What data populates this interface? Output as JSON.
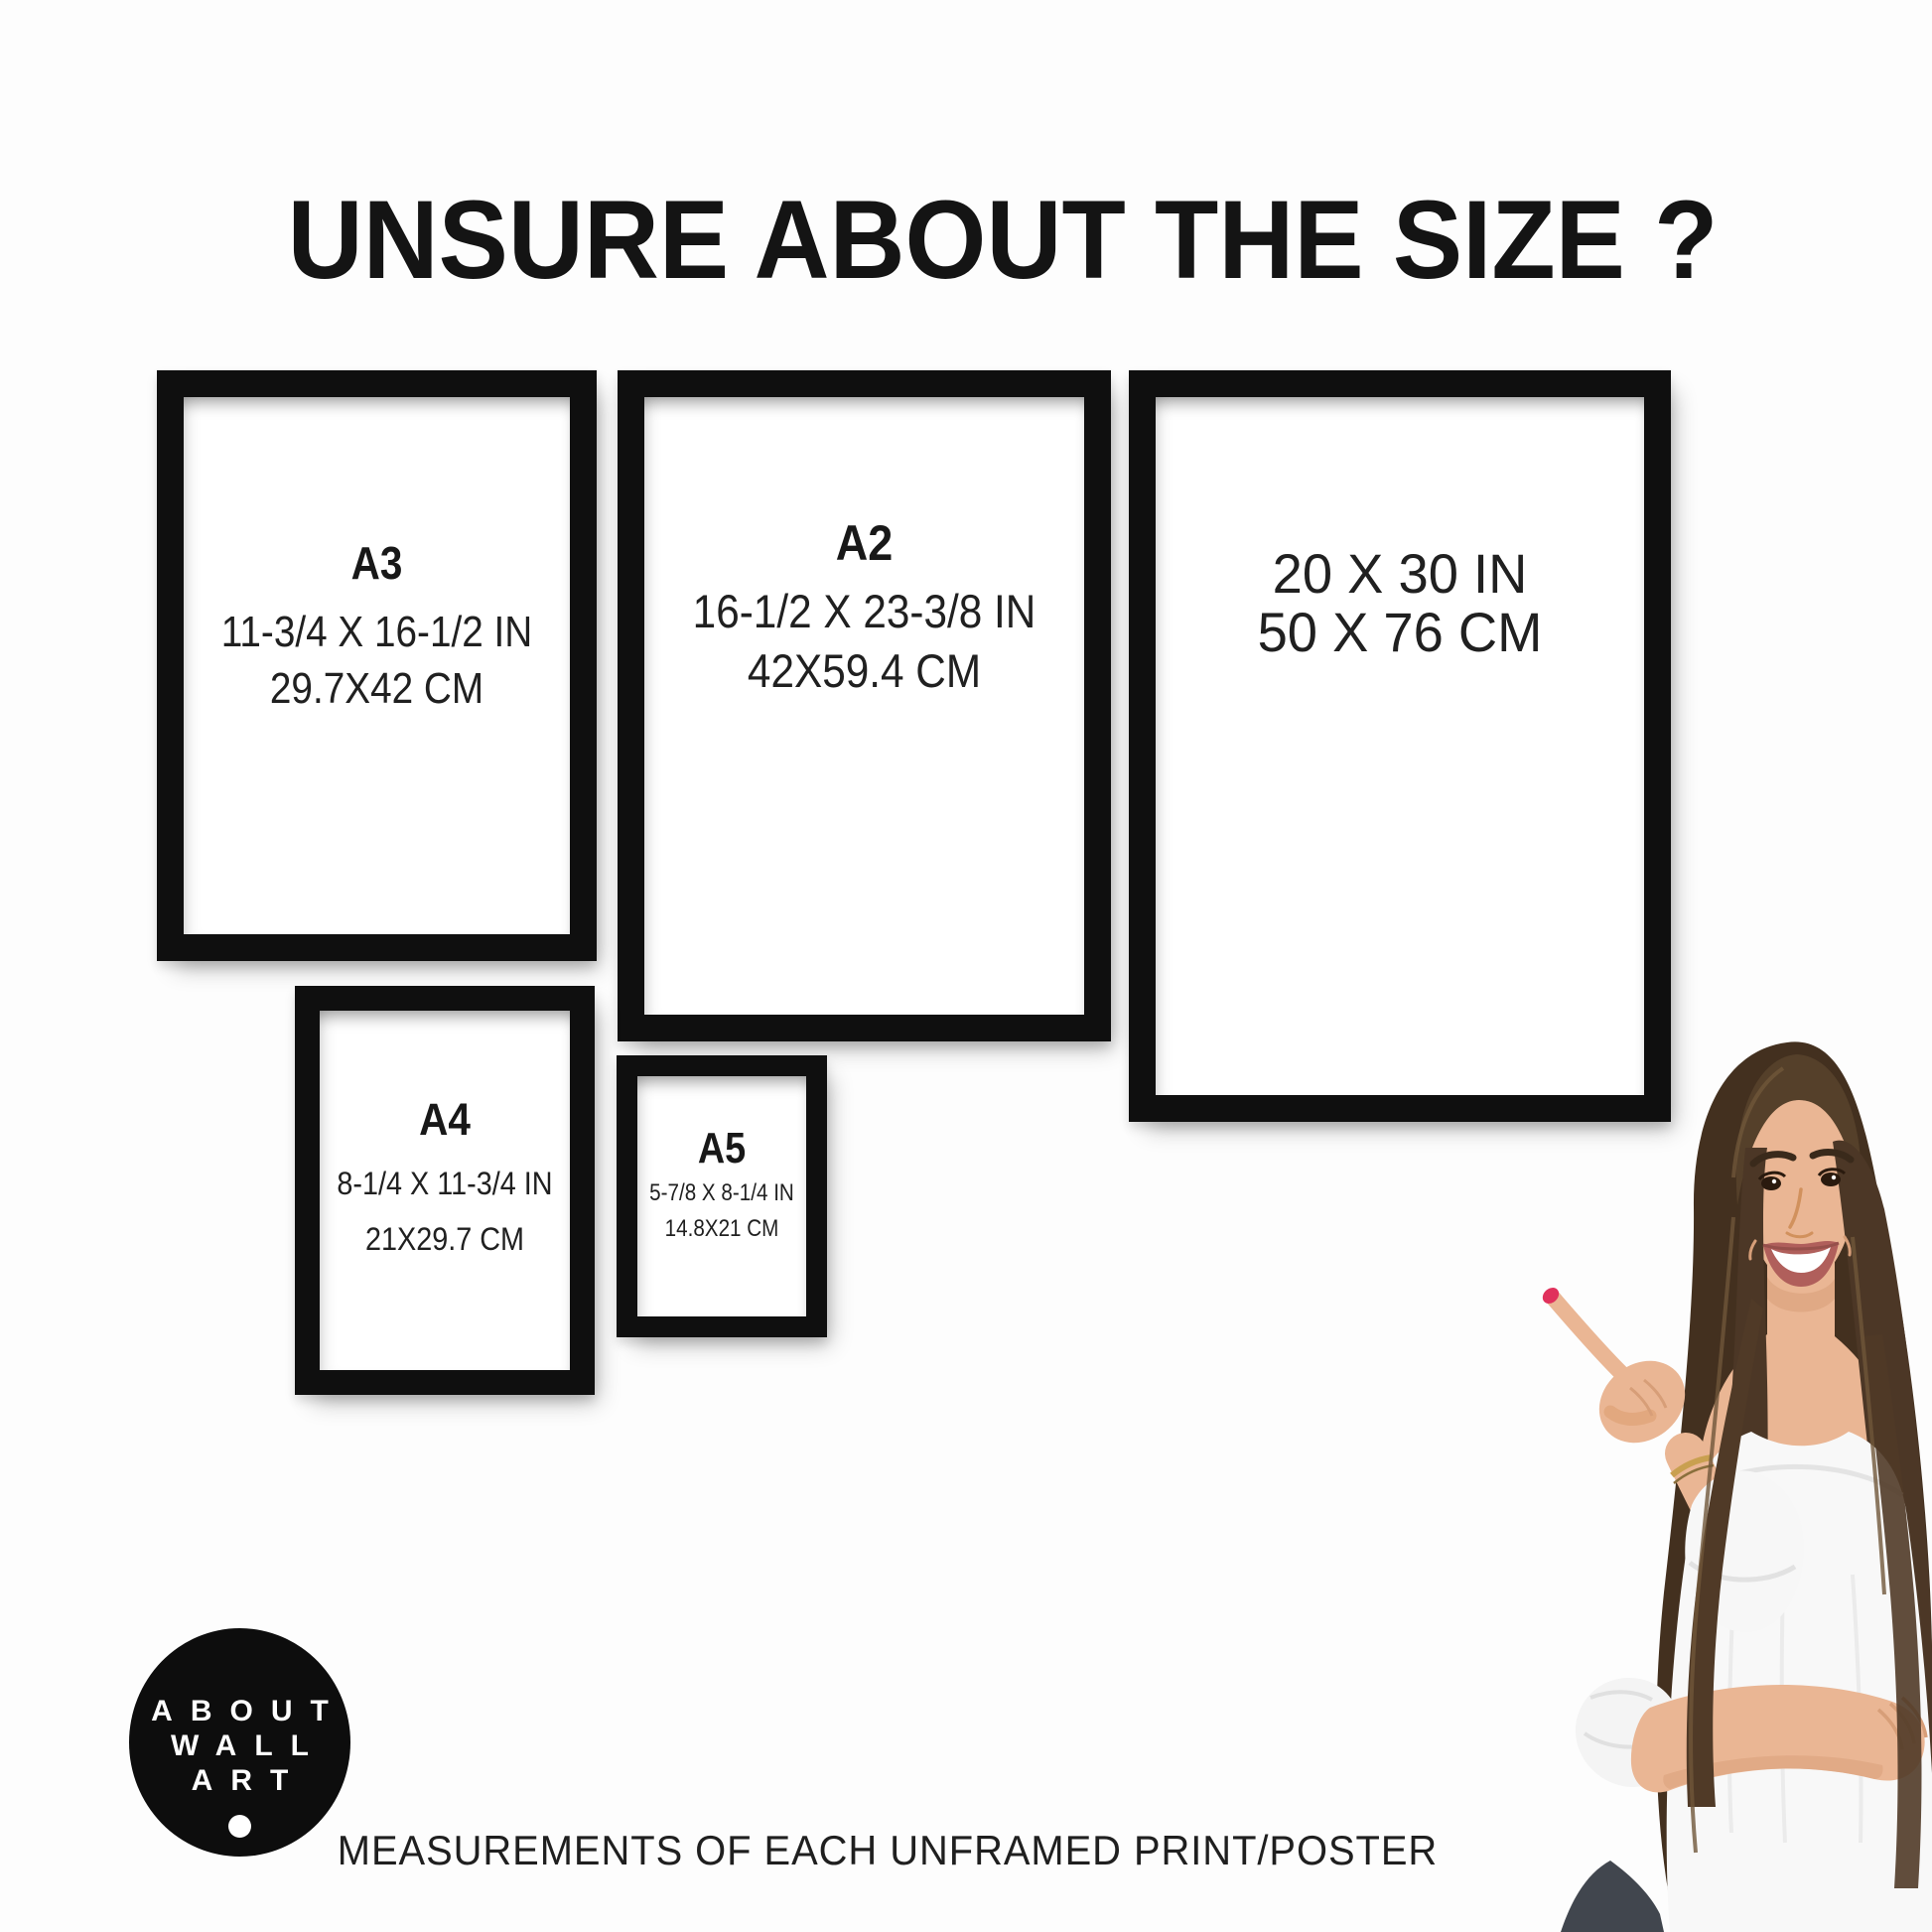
{
  "header": {
    "title": "UNSURE ABOUT THE SIZE ?"
  },
  "frames": [
    {
      "name": "A3",
      "inches": "11-3/4 X 16-1/2 IN",
      "cm": "29.7X42 CM"
    },
    {
      "name": "A2",
      "inches": "16-1/2 X 23-3/8 IN",
      "cm": "42X59.4 CM"
    },
    {
      "name": "",
      "inches": "20 X 30 IN",
      "cm": "50 X 76 CM"
    },
    {
      "name": "A4",
      "inches": "8-1/4 X 11-3/4 IN",
      "cm": "21X29.7 CM"
    },
    {
      "name": "A5",
      "inches": "5-7/8 X 8-1/4 IN",
      "cm": "14.8X21 CM"
    }
  ],
  "logo": {
    "line1": "ABOUT",
    "line2": "WALL",
    "line3": "ART"
  },
  "footer": {
    "caption": "MEASUREMENTS OF EACH UNFRAMED PRINT/POSTER"
  },
  "colors": {
    "background": "#fdfdfd",
    "frame": "#0f0f0f",
    "text": "#1a1a1a",
    "logo_background": "#0d0d0d",
    "logo_text": "#ffffff",
    "hair": "#43301f",
    "skin": "#eab694",
    "blouse": "#f8f8f8",
    "nail": "#e0315c"
  }
}
